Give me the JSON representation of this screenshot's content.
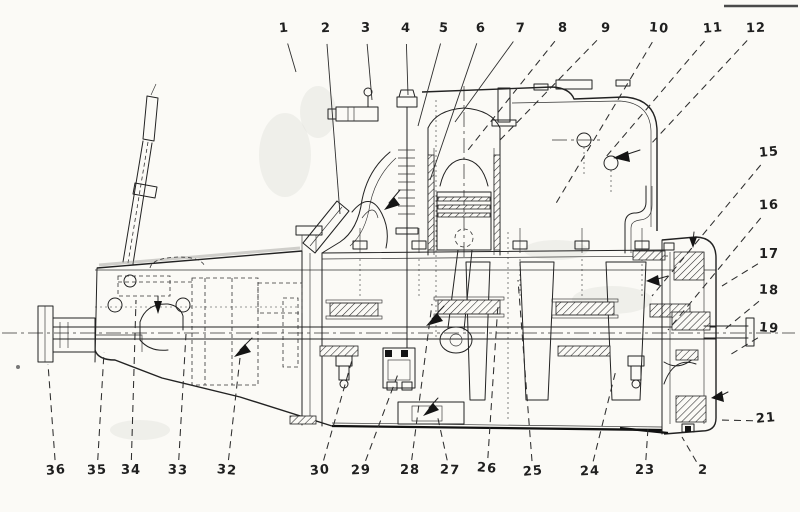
{
  "figure": {
    "kind_note": "scanned engine and gearbox cutaway drawing",
    "colors": {
      "ink": "#222222",
      "paper": "#fbfaf6",
      "leader": "#2e2e2e",
      "smudge": "#dededa"
    }
  },
  "callouts": {
    "top": [
      {
        "label": "1",
        "x": 284,
        "y": 31,
        "tx": 296,
        "ty": 72,
        "style": "solid"
      },
      {
        "label": "2",
        "x": 326,
        "y": 31,
        "tx": 340,
        "ty": 214,
        "style": "solid"
      },
      {
        "label": "3",
        "x": 366,
        "y": 31,
        "tx": 372,
        "ty": 100,
        "style": "solid"
      },
      {
        "label": "4",
        "x": 406,
        "y": 31,
        "tx": 408,
        "ty": 95,
        "style": "solid"
      },
      {
        "label": "5",
        "x": 444,
        "y": 31,
        "tx": 418,
        "ty": 126,
        "style": "solid"
      },
      {
        "label": "6",
        "x": 481,
        "y": 31,
        "tx": 430,
        "ty": 180,
        "style": "solid"
      },
      {
        "label": "7",
        "x": 521,
        "y": 31,
        "tx": 455,
        "ty": 122,
        "style": "solid"
      },
      {
        "label": "8",
        "x": 563,
        "y": 31,
        "tx": 468,
        "ty": 150,
        "style": "dashed"
      },
      {
        "label": "9",
        "x": 606,
        "y": 31,
        "tx": 500,
        "ty": 140,
        "style": "dashed"
      },
      {
        "label": "10",
        "x": 659,
        "y": 31,
        "tx": 555,
        "ty": 205,
        "style": "dashed"
      },
      {
        "label": "11",
        "x": 713,
        "y": 31,
        "tx": 605,
        "ty": 158,
        "style": "dashed"
      },
      {
        "label": "12",
        "x": 756,
        "y": 31,
        "tx": 650,
        "ty": 145,
        "style": "dashed"
      }
    ],
    "right": [
      {
        "label": "15",
        "x": 769,
        "y": 155,
        "tx": 652,
        "ty": 296,
        "style": "dashed"
      },
      {
        "label": "16",
        "x": 769,
        "y": 208,
        "tx": 668,
        "ty": 330,
        "style": "dashed"
      },
      {
        "label": "17",
        "x": 769,
        "y": 257,
        "tx": 722,
        "ty": 286,
        "style": "dashed"
      },
      {
        "label": "18",
        "x": 769,
        "y": 293,
        "tx": 724,
        "ty": 330,
        "style": "dashed"
      },
      {
        "label": "19",
        "x": 769,
        "y": 331,
        "tx": 728,
        "ty": 356,
        "style": "dashed"
      },
      {
        "label": "21",
        "x": 766,
        "y": 421,
        "tx": 718,
        "ty": 420,
        "style": "dashed"
      }
    ],
    "bottom": [
      {
        "label": "36",
        "x": 56,
        "y": 473,
        "tx": 48,
        "ty": 364,
        "style": "dashed"
      },
      {
        "label": "35",
        "x": 97,
        "y": 473,
        "tx": 104,
        "ty": 352,
        "style": "dashed"
      },
      {
        "label": "34",
        "x": 131,
        "y": 473,
        "tx": 136,
        "ty": 300,
        "style": "dashed"
      },
      {
        "label": "33",
        "x": 178,
        "y": 473,
        "tx": 186,
        "ty": 334,
        "style": "dashed"
      },
      {
        "label": "32",
        "x": 227,
        "y": 473,
        "tx": 240,
        "ty": 358,
        "style": "dashed"
      },
      {
        "label": "30",
        "x": 320,
        "y": 473,
        "tx": 352,
        "ty": 360,
        "style": "dashed"
      },
      {
        "label": "29",
        "x": 361,
        "y": 473,
        "tx": 398,
        "ty": 374,
        "style": "dashed"
      },
      {
        "label": "28",
        "x": 410,
        "y": 473,
        "tx": 432,
        "ty": 304,
        "style": "dashed"
      },
      {
        "label": "27",
        "x": 450,
        "y": 473,
        "tx": 437,
        "ty": 414,
        "style": "dashed"
      },
      {
        "label": "26",
        "x": 487,
        "y": 471,
        "tx": 498,
        "ty": 304,
        "style": "dashed"
      },
      {
        "label": "25",
        "x": 533,
        "y": 474,
        "tx": 518,
        "ty": 280,
        "style": "dashed"
      },
      {
        "label": "24",
        "x": 590,
        "y": 474,
        "tx": 616,
        "ty": 370,
        "style": "dashed"
      },
      {
        "label": "23",
        "x": 645,
        "y": 473,
        "tx": 648,
        "ty": 428,
        "style": "dashed"
      },
      {
        "label": "2",
        "x": 703,
        "y": 473,
        "tx": 682,
        "ty": 437,
        "style": "dashed"
      }
    ]
  }
}
